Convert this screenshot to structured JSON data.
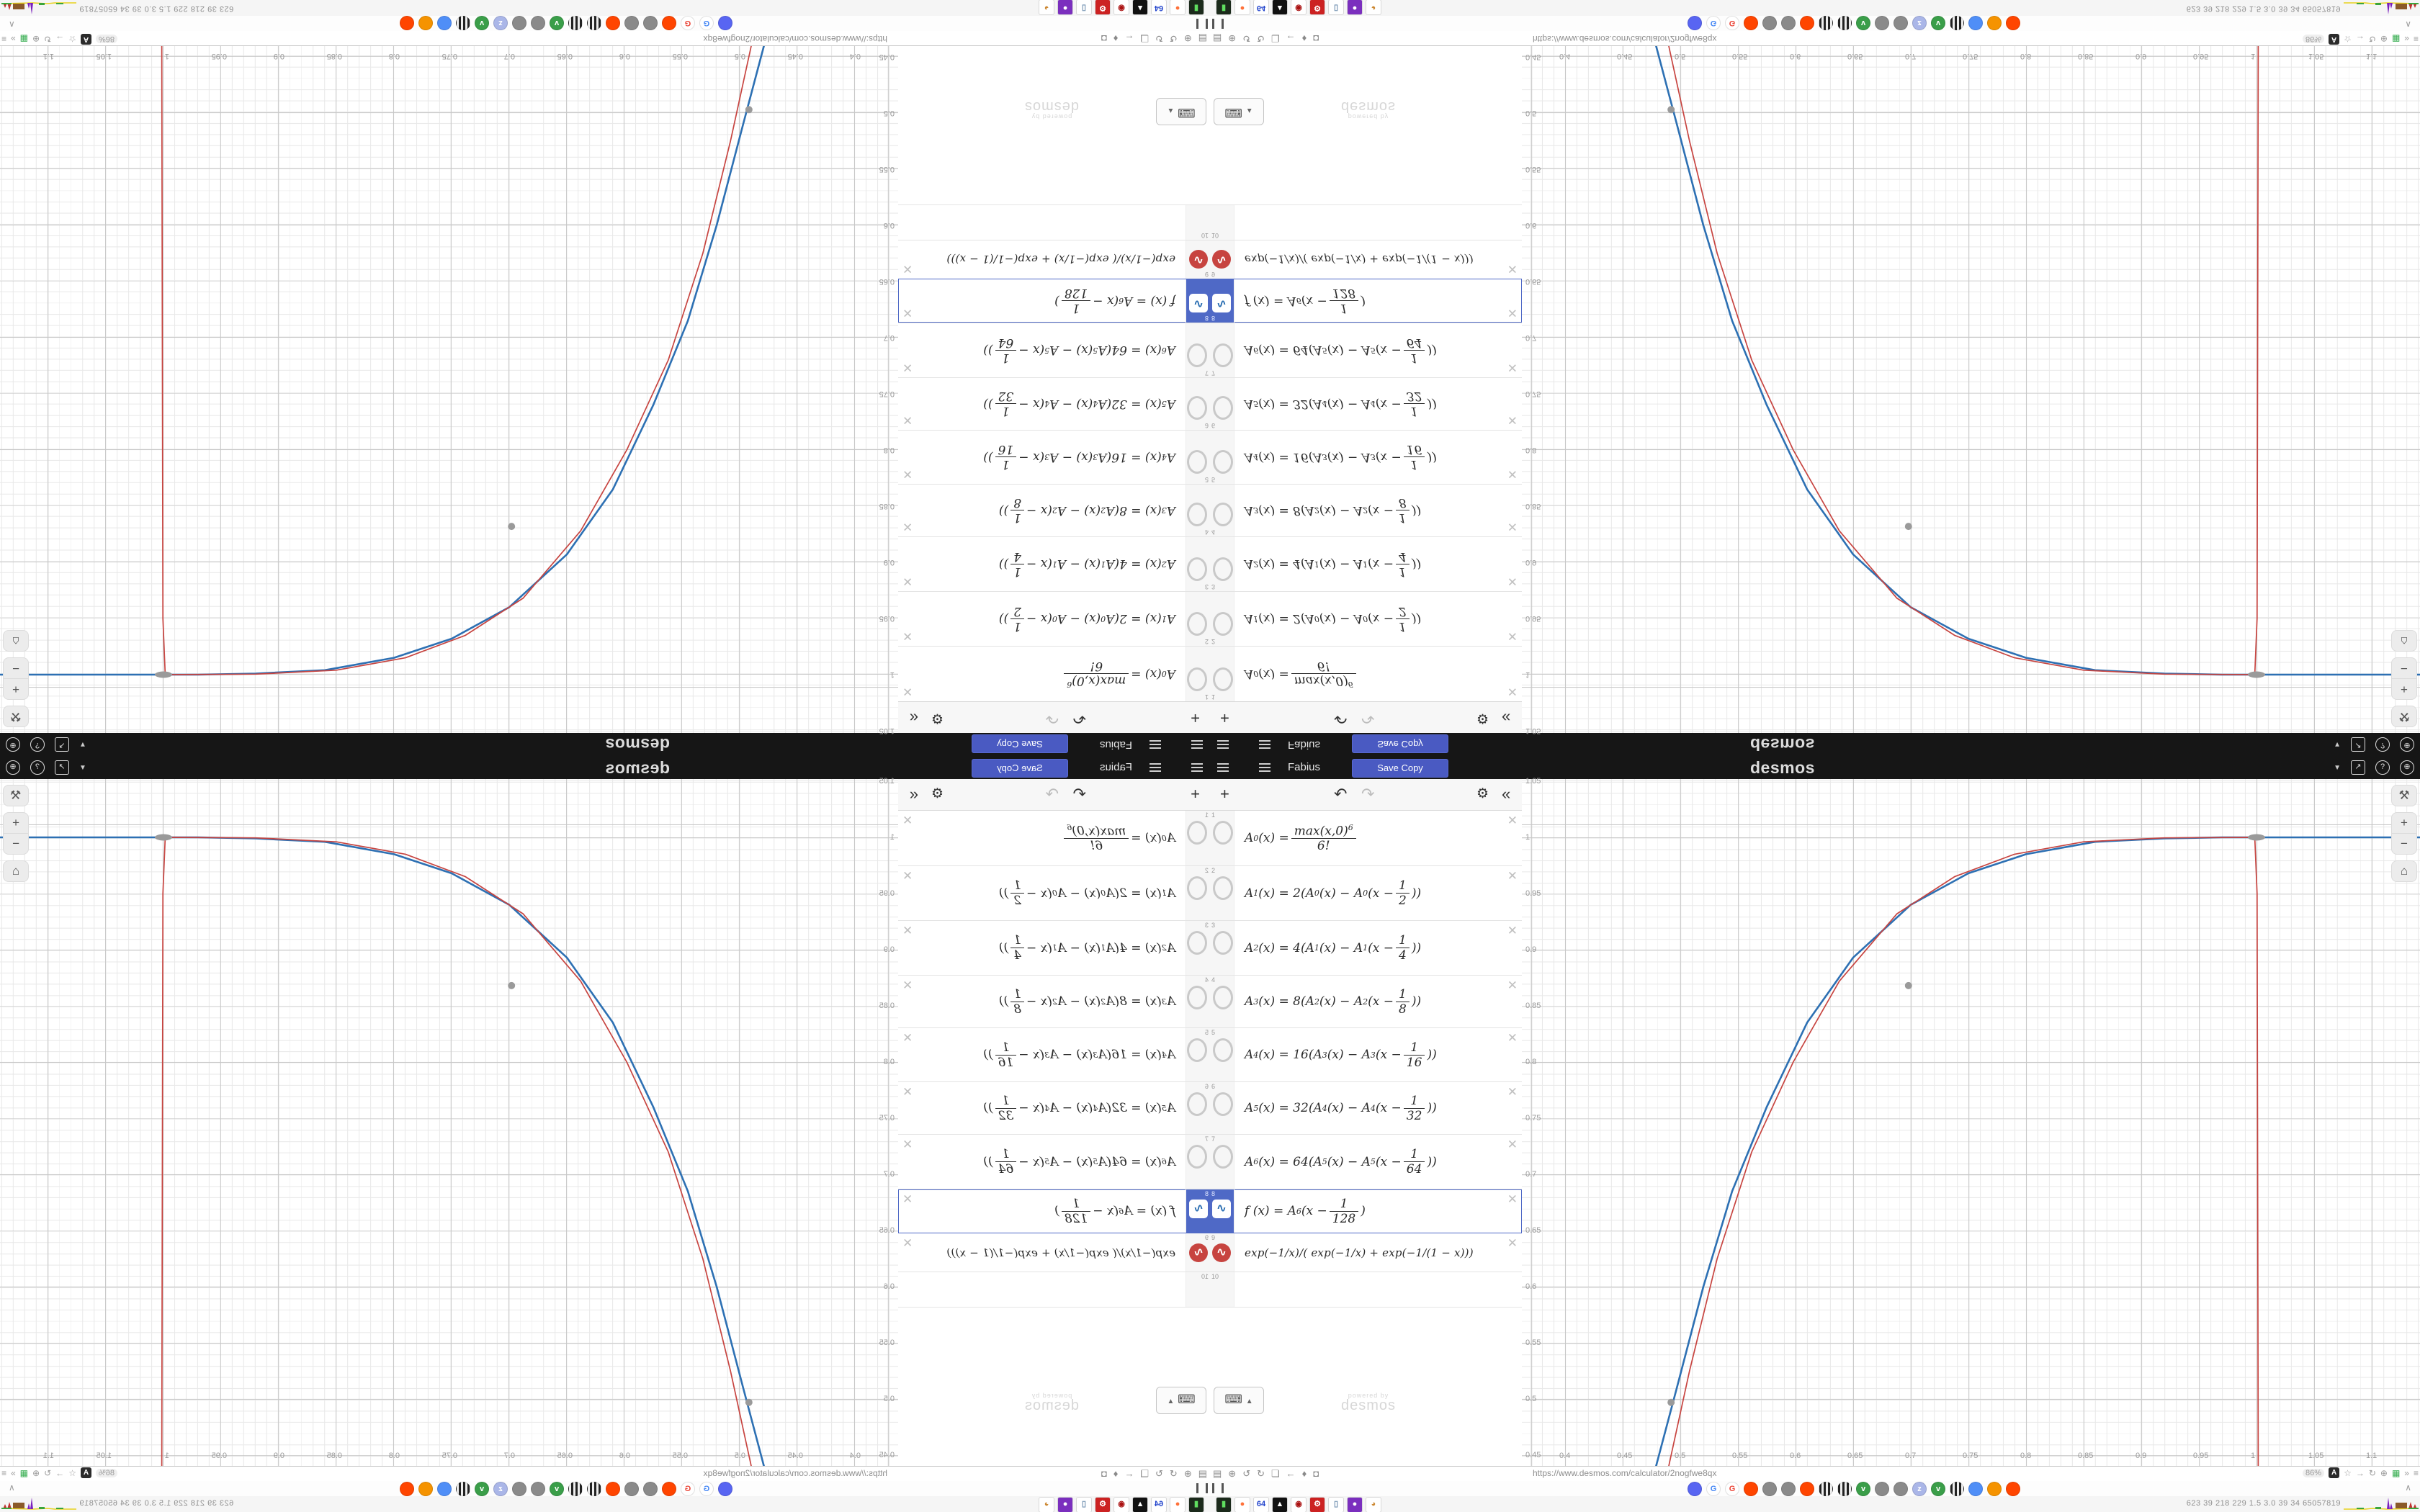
{
  "header": {
    "title": "Fabius",
    "save_button": "Save Copy",
    "brand": "desmos",
    "accent": "#4a5ac2",
    "bg": "#161616",
    "right_icons": [
      "caret-down-icon",
      "share-icon",
      "help-icon",
      "globe-icon"
    ],
    "help_glyph": "?",
    "share_glyph": "↗",
    "globe_glyph": "⊕",
    "caret_glyph": "▼"
  },
  "expressions": {
    "toolbar": {
      "add": "+",
      "undo": "↶",
      "redo": "↷",
      "settings": "⚙",
      "collapse": "«"
    },
    "delete_glyph": "✕",
    "wave_glyph": "∿",
    "rows": [
      {
        "num": "1",
        "math": "A_0(x) = frac{max(x,0)^6}{6!}",
        "icon": "hidden",
        "h": 76
      },
      {
        "num": "2",
        "math": "A_1(x) = 2(A_0(x) − A_0(x − frac{1}{2}))",
        "icon": "hidden",
        "h": 75
      },
      {
        "num": "3",
        "math": "A_2(x) = 4(A_1(x) − A_1(x − frac{1}{4}))",
        "icon": "hidden",
        "h": 75
      },
      {
        "num": "4",
        "math": "A_3(x) = 8(A_2(x) − A_2(x − frac{1}{8}))",
        "icon": "hidden",
        "h": 72
      },
      {
        "num": "5",
        "math": "A_4(x) = 16(A_3(x) − A_3(x − frac{1}{16}))",
        "icon": "hidden",
        "h": 74
      },
      {
        "num": "6",
        "math": "A_5(x) = 32(A_4(x) − A_4(x − frac{1}{32}))",
        "icon": "hidden",
        "h": 72
      },
      {
        "num": "7",
        "math": "A_6(x) = 64(A_5(x) − A_5(x − frac{1}{64}))",
        "icon": "hidden",
        "h": 75
      },
      {
        "num": "8",
        "math": "f (x) = A_6(x − frac{1}{128})",
        "icon": "wave-blue",
        "selected": true,
        "h": 60
      },
      {
        "num": "9",
        "math": "exp(−1/x)/( exp(−1/x) + exp(−1/(1 − x)))",
        "icon": "wave-red",
        "plain": true,
        "h": 53
      },
      {
        "num": "10",
        "math": "",
        "icon": "none",
        "h": 48
      }
    ],
    "keypad_button": {
      "icon": "keyboard-icon",
      "glyph": "⌨",
      "caret": "▲"
    },
    "watermark": {
      "line1": "powered by",
      "line2": "desmos"
    }
  },
  "chart_data": {
    "type": "line",
    "title": "",
    "xlabel": "",
    "ylabel": "",
    "window": {
      "xmin": 0.3625,
      "xmax": 1.1419,
      "ymin": 0.4404,
      "ymax": 1.0519
    },
    "x_ticks": [
      0.4,
      0.45,
      0.5,
      0.55,
      0.6,
      0.65,
      0.7,
      0.75,
      0.8,
      0.85,
      0.9,
      0.95,
      1,
      1.05,
      1.1
    ],
    "y_ticks": [
      1.05,
      1,
      0.95,
      0.9,
      0.85,
      0.8,
      0.75,
      0.7,
      0.65,
      0.6,
      0.55,
      0.5,
      0.45
    ],
    "x_tick_labels": [
      "0.4",
      "0.45",
      "0.5",
      "0.55",
      "0.6",
      "0.65",
      "0.7",
      "0.75",
      "0.8",
      "0.85",
      "0.9",
      "0.95",
      "1",
      "1.05",
      "1.1"
    ],
    "y_tick_labels": [
      "1.05",
      "1",
      "0.95",
      "0.9",
      "0.85",
      "0.8",
      "0.75",
      "0.7",
      "0.65",
      "0.6",
      "0.55",
      "0.5",
      "0.45"
    ],
    "grid": "on",
    "series": [
      {
        "name": "f(x) = A6(x - 1/128)",
        "color": "#2d70b3",
        "width": 2.6,
        "points": [
          [
            0.479,
            0.4404
          ],
          [
            0.497,
            0.51
          ],
          [
            0.52,
            0.6
          ],
          [
            0.545,
            0.685
          ],
          [
            0.575,
            0.76
          ],
          [
            0.61,
            0.835
          ],
          [
            0.65,
            0.893
          ],
          [
            0.7,
            0.94
          ],
          [
            0.75,
            0.968
          ],
          [
            0.8,
            0.985
          ],
          [
            0.86,
            0.996
          ],
          [
            0.92,
            0.999
          ],
          [
            0.97,
            1.0
          ],
          [
            1.1419,
            1.0
          ]
        ]
      },
      {
        "name": "exp(-1/x)/(exp(-1/x)+exp(-1/(1-x)))",
        "color": "#c74440",
        "width": 1.7,
        "points": [
          [
            0.49,
            0.4404
          ],
          [
            0.508,
            0.525
          ],
          [
            0.532,
            0.625
          ],
          [
            0.562,
            0.72
          ],
          [
            0.598,
            0.8
          ],
          [
            0.638,
            0.872
          ],
          [
            0.688,
            0.932
          ],
          [
            0.738,
            0.965
          ],
          [
            0.79,
            0.985
          ],
          [
            0.85,
            0.996
          ],
          [
            0.92,
            0.9995
          ],
          [
            0.9985,
            1.0
          ],
          [
            1.0005,
            0.95
          ],
          [
            1.001,
            0.7
          ],
          [
            1.0015,
            0.4404
          ]
        ]
      }
    ],
    "markers": {
      "color": "#9a9a9a",
      "points": [
        [
          0.492,
          0.497
        ],
        [
          0.698,
          0.868
        ]
      ],
      "pill_point": [
        1.0,
        1.0
      ]
    },
    "controls": [
      "wrench-icon",
      "zoom-in-button",
      "zoom-out-button",
      "home-button"
    ],
    "control_glyphs": {
      "wrench": "⚒",
      "zoom_in": "+",
      "zoom_out": "−",
      "home": "⌂"
    }
  },
  "browser": {
    "url": "https://www.desmos.com/calculator/2nogfwe8qx",
    "zoom_level": "86%",
    "nav_icons": [
      "trash-icon",
      "globe-icon",
      "reload-icon",
      "back-reload-icon",
      "folder-icon",
      "back-arrow-icon",
      "shield-icon",
      "lock-icon"
    ],
    "nav_glyphs": [
      "▤",
      "⊕",
      "↺",
      "↻",
      "❏",
      "←",
      "♦",
      "◘"
    ],
    "right_icons": [
      "translate-icon",
      "star-icon",
      "arrow-right-icon",
      "reload-icon",
      "globe-icon",
      "puzzle-icon",
      "overflow-icon",
      "menu-icon"
    ],
    "right_glyphs": {
      "translate": "A",
      "star": "☆",
      "arrow": "→",
      "reload": "↻",
      "globe": "⊕",
      "puzzle": "▦",
      "overflow": "»",
      "menu": "≡"
    },
    "tab_pause_icon": "pause-icon",
    "tab_caret": "∧",
    "favicons": [
      {
        "name": "discord",
        "bg": "#5865F2",
        "glyph": ""
      },
      {
        "name": "google",
        "bg": "#ffffff",
        "glyph": "G",
        "fg": "#4285F4"
      },
      {
        "name": "google",
        "bg": "#ffffff",
        "glyph": "G",
        "fg": "#EA4335"
      },
      {
        "name": "reddit",
        "bg": "#FF4500",
        "glyph": ""
      },
      {
        "name": "bat",
        "bg": "#8a8a8a",
        "glyph": ""
      },
      {
        "name": "bat",
        "bg": "#8a8a8a",
        "glyph": ""
      },
      {
        "name": "reddit",
        "bg": "#FF4500",
        "glyph": ""
      },
      {
        "name": "archive",
        "bg": "striped",
        "glyph": ""
      },
      {
        "name": "archive",
        "bg": "striped",
        "glyph": ""
      },
      {
        "name": "green-v",
        "bg": "#3a9e49",
        "glyph": "v"
      },
      {
        "name": "bat",
        "bg": "#8a8a8a",
        "glyph": ""
      },
      {
        "name": "bat",
        "bg": "#8a8a8a",
        "glyph": ""
      },
      {
        "name": "sleep",
        "bg": "#aab6e8",
        "glyph": "z"
      },
      {
        "name": "green-v",
        "bg": "#3a9e49",
        "glyph": "v"
      },
      {
        "name": "archive",
        "bg": "striped",
        "glyph": ""
      },
      {
        "name": "chat",
        "bg": "#4f8ef7",
        "glyph": ""
      },
      {
        "name": "gear",
        "bg": "#f59300",
        "glyph": ""
      },
      {
        "name": "reddit",
        "bg": "#FF4500",
        "glyph": ""
      }
    ]
  },
  "taskbar": {
    "apps": [
      {
        "name": "terminal",
        "bg": "#1b2a1b",
        "glyph": "▮",
        "fg": "#5fdf5f"
      },
      {
        "name": "firefox",
        "bg": "#ffffff",
        "glyph": "●",
        "fg": "#ff7139"
      },
      {
        "name": "floppy-64",
        "bg": "#ffffff",
        "glyph": "64",
        "fg": "#2244cc"
      },
      {
        "name": "wolf",
        "bg": "#111111",
        "glyph": "▲",
        "fg": "#ffffff"
      },
      {
        "name": "red-badge",
        "bg": "#ffffff",
        "glyph": "◉",
        "fg": "#aa1111"
      },
      {
        "name": "red-gear",
        "bg": "#cc2222",
        "glyph": "⚙",
        "fg": "#ffffff"
      },
      {
        "name": "notepad",
        "bg": "#ffffff",
        "glyph": "▯",
        "fg": "#7090b0"
      },
      {
        "name": "purple-cam",
        "bg": "#7b2fbe",
        "glyph": "●",
        "fg": "#ffffff"
      },
      {
        "name": "palette",
        "bg": "#ffffff",
        "glyph": "◕",
        "fg": "#cc8833"
      }
    ],
    "stats_text": "623   39   218  229   1.5   3.0   39   34  65057819"
  }
}
